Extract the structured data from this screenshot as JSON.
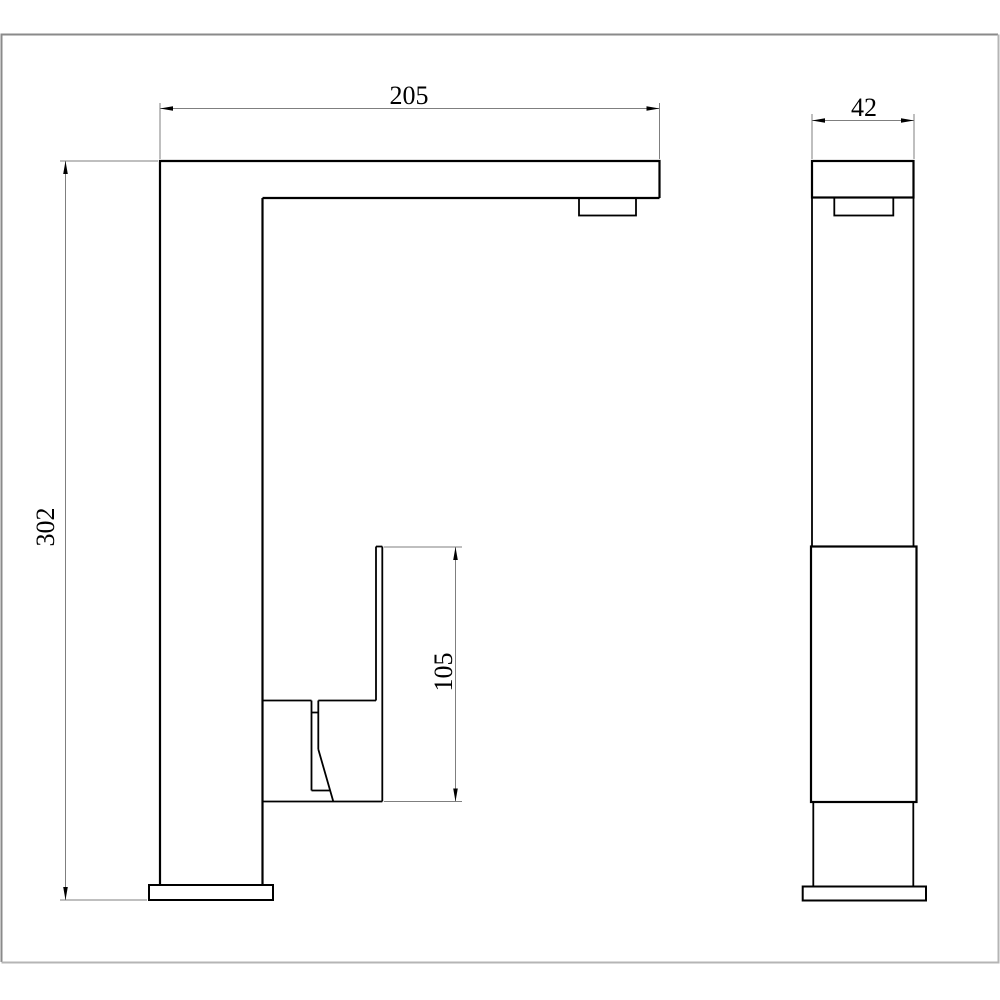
{
  "page": {
    "background": "#ffffff"
  },
  "frame": {
    "border_color_dark": "#7a7a7a",
    "border_color_light": "#c6c6c6"
  },
  "drawing": {
    "type": "orthographic-technical-drawing",
    "subject": "tall-single-lever-faucet",
    "views": [
      {
        "id": "front",
        "position": "left"
      },
      {
        "id": "side",
        "position": "right"
      }
    ],
    "dimensions": {
      "top_width": {
        "label": "205",
        "orientation": "horizontal",
        "position": "top-of-front-view"
      },
      "side_width": {
        "label": "42",
        "orientation": "horizontal",
        "position": "top-of-side-view"
      },
      "total_height": {
        "label": "302",
        "orientation": "vertical",
        "position": "left-of-front-view"
      },
      "handle_height": {
        "label": "105",
        "orientation": "vertical",
        "position": "right-of-handle"
      }
    },
    "style": {
      "object_line_color": "#000000",
      "dimension_line_color": "#7f7f7f",
      "text_color": "#000000"
    }
  }
}
